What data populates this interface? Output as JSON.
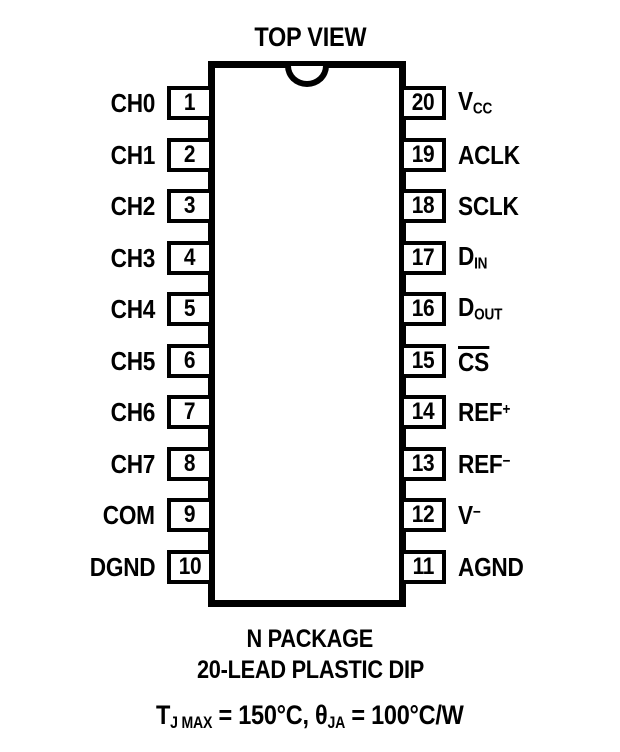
{
  "title": "TOP VIEW",
  "colors": {
    "ink": "#000000",
    "background": "#ffffff"
  },
  "package": {
    "notch": "top-center-semicircle",
    "left_pins": [
      {
        "num": "1",
        "label": [
          {
            "t": "CH0"
          }
        ]
      },
      {
        "num": "2",
        "label": [
          {
            "t": "CH1"
          }
        ]
      },
      {
        "num": "3",
        "label": [
          {
            "t": "CH2"
          }
        ]
      },
      {
        "num": "4",
        "label": [
          {
            "t": "CH3"
          }
        ]
      },
      {
        "num": "5",
        "label": [
          {
            "t": "CH4"
          }
        ]
      },
      {
        "num": "6",
        "label": [
          {
            "t": "CH5"
          }
        ]
      },
      {
        "num": "7",
        "label": [
          {
            "t": "CH6"
          }
        ]
      },
      {
        "num": "8",
        "label": [
          {
            "t": "CH7"
          }
        ]
      },
      {
        "num": "9",
        "label": [
          {
            "t": "COM"
          }
        ]
      },
      {
        "num": "10",
        "label": [
          {
            "t": "DGND"
          }
        ]
      }
    ],
    "right_pins": [
      {
        "num": "20",
        "label": [
          {
            "t": "V"
          },
          {
            "sub": "CC"
          }
        ]
      },
      {
        "num": "19",
        "label": [
          {
            "t": "ACLK"
          }
        ]
      },
      {
        "num": "18",
        "label": [
          {
            "t": "SCLK"
          }
        ]
      },
      {
        "num": "17",
        "label": [
          {
            "t": "D"
          },
          {
            "sub": "IN"
          }
        ]
      },
      {
        "num": "16",
        "label": [
          {
            "t": "D"
          },
          {
            "sub": "OUT"
          }
        ]
      },
      {
        "num": "15",
        "label": [
          {
            "over": "CS"
          }
        ]
      },
      {
        "num": "14",
        "label": [
          {
            "t": "REF"
          },
          {
            "sup": "+"
          }
        ]
      },
      {
        "num": "13",
        "label": [
          {
            "t": "REF"
          },
          {
            "sup": "−"
          }
        ]
      },
      {
        "num": "12",
        "label": [
          {
            "t": "V"
          },
          {
            "sup": "−"
          }
        ]
      },
      {
        "num": "11",
        "label": [
          {
            "t": "AGND"
          }
        ]
      }
    ]
  },
  "captions": {
    "package_name": "N PACKAGE",
    "package_type": "20-LEAD PLASTIC DIP"
  },
  "thermal_note": [
    {
      "t": "T"
    },
    {
      "sub": "J MAX"
    },
    {
      "t": " = 150°C, "
    },
    {
      "t": "θ"
    },
    {
      "sub": "JA"
    },
    {
      "t": " = 100°C/W"
    }
  ]
}
